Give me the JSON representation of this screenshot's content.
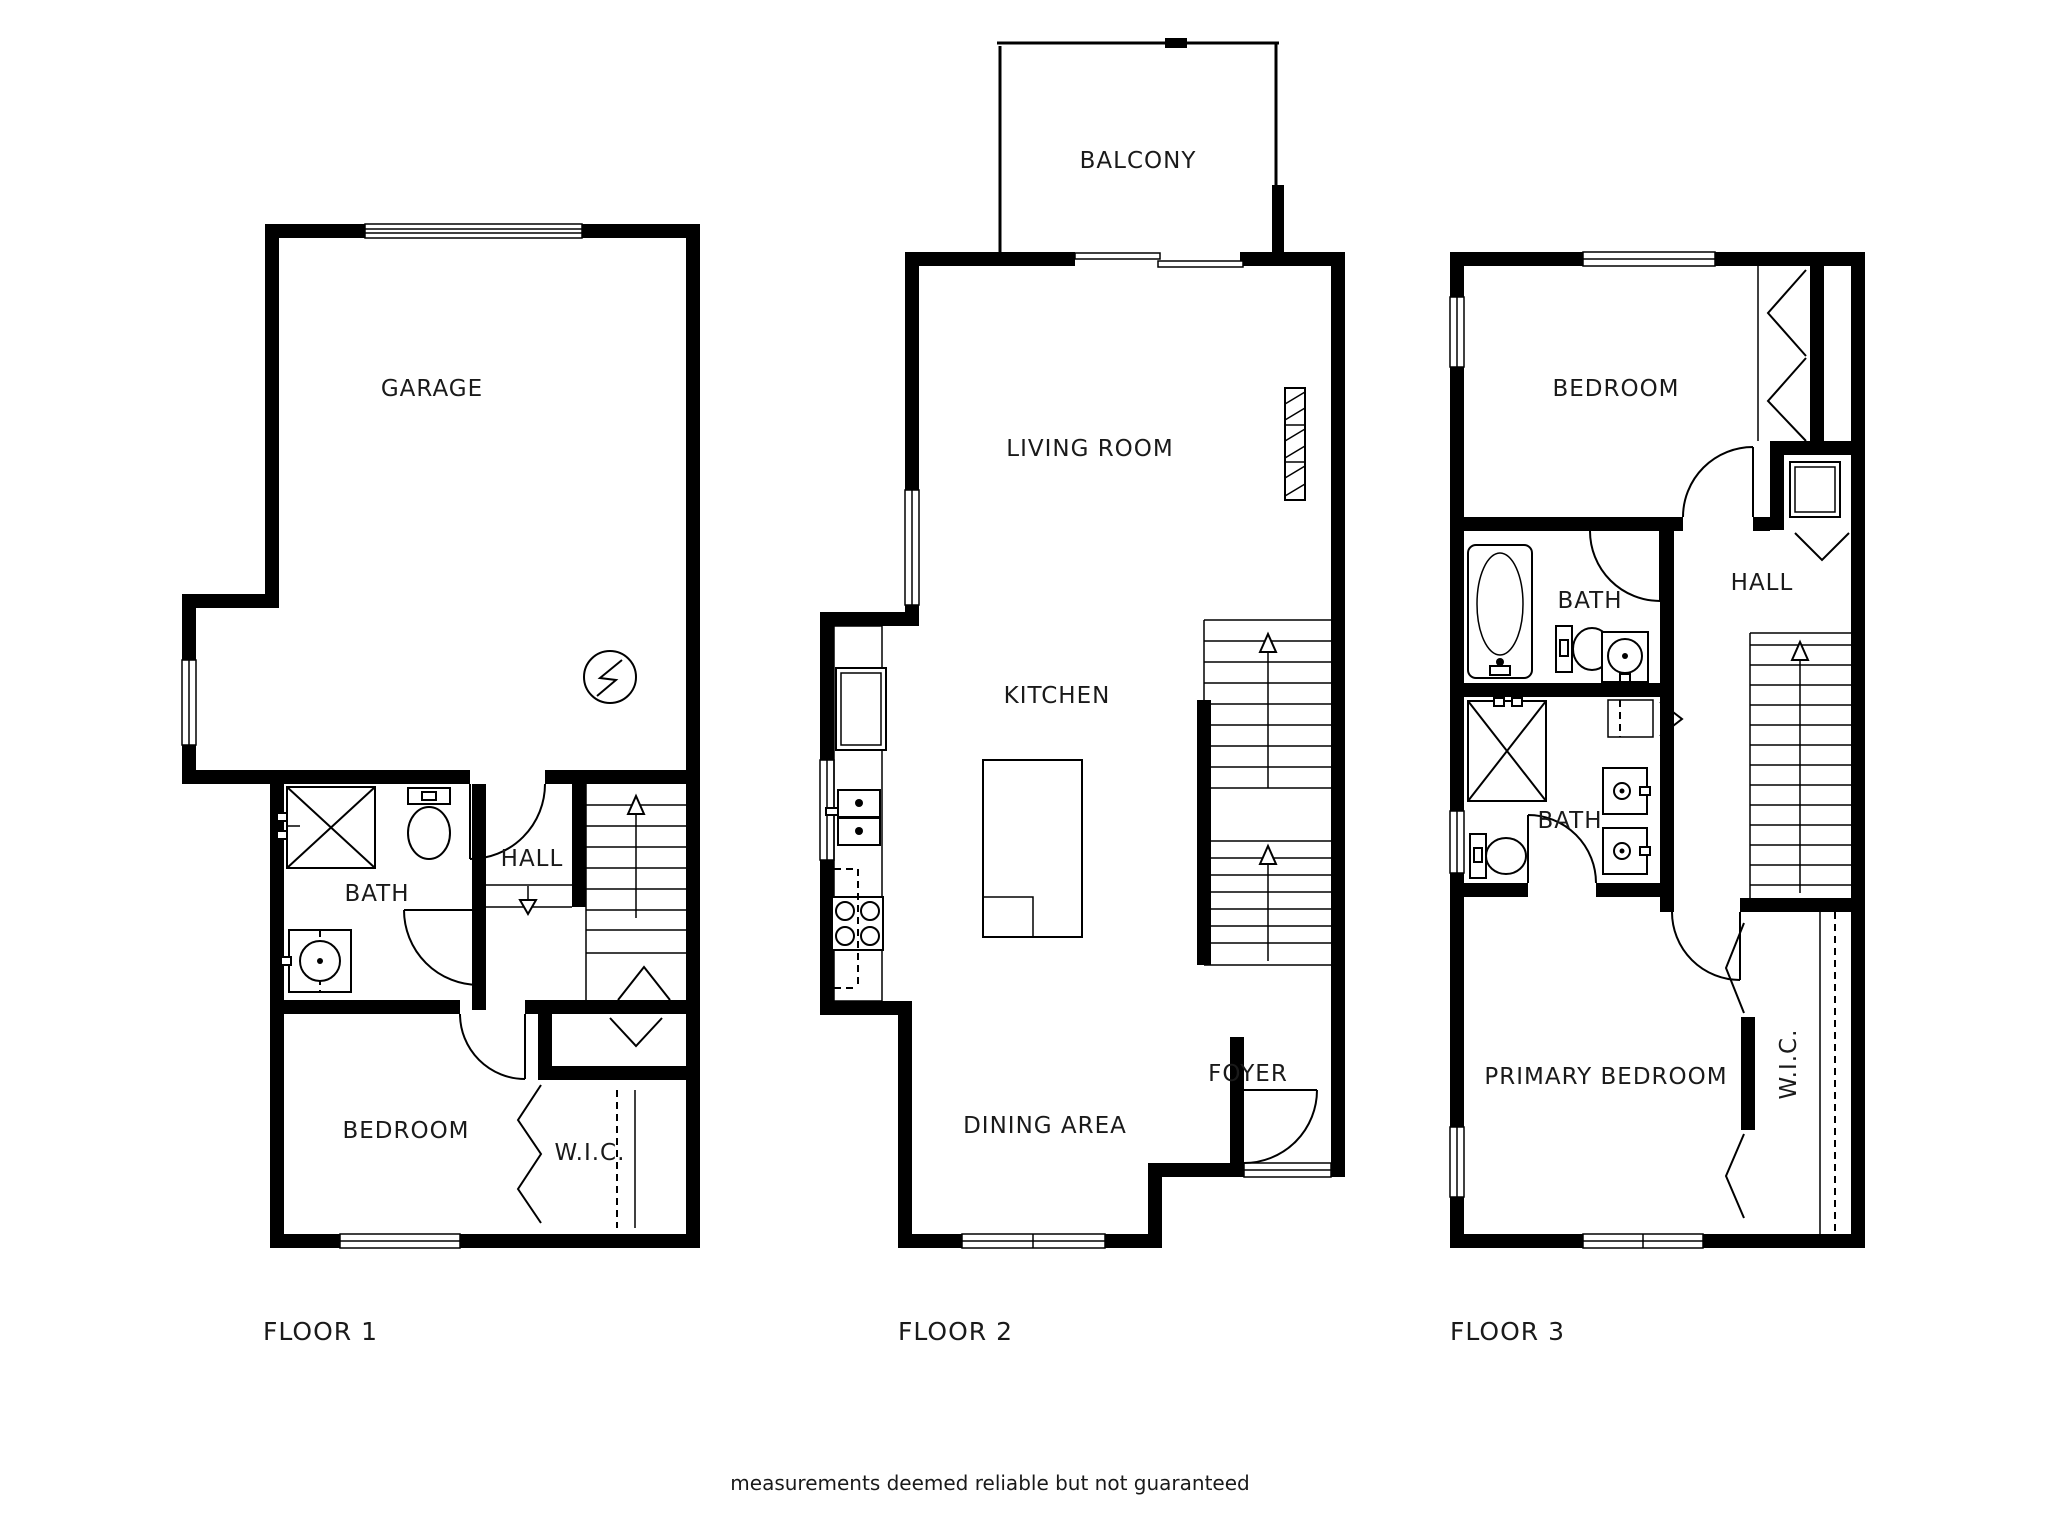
{
  "colors": {
    "wall": "#000000",
    "background": "#ffffff",
    "text": "#1a1a1a"
  },
  "floors": [
    {
      "label": "FLOOR 1",
      "rooms": {
        "garage": "GARAGE",
        "bath": "BATH",
        "hall": "HALL",
        "bedroom": "BEDROOM",
        "wic": "W.I.C."
      }
    },
    {
      "label": "FLOOR 2",
      "rooms": {
        "balcony": "BALCONY",
        "living": "LIVING ROOM",
        "kitchen": "KITCHEN",
        "dining": "DINING AREA",
        "foyer": "FOYER"
      }
    },
    {
      "label": "FLOOR 3",
      "rooms": {
        "bedroom": "BEDROOM",
        "bath_upper": "BATH",
        "hall": "HALL",
        "bath_lower": "BATH",
        "primary": "PRIMARY BEDROOM",
        "wic": "W.I.C."
      }
    }
  ],
  "footer": {
    "disclaimer": "measurements deemed reliable but not guaranteed"
  }
}
